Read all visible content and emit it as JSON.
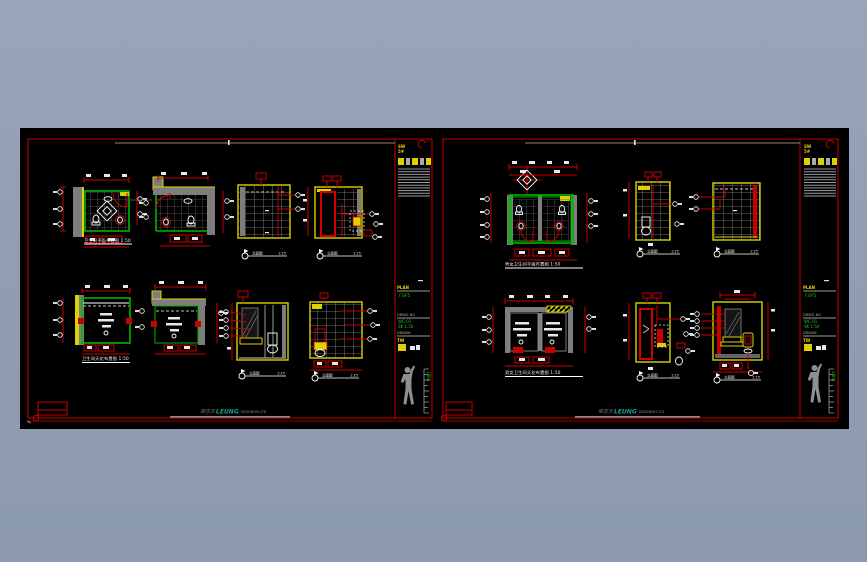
{
  "palette": {
    "background": "#909db2",
    "sheet": "#000000",
    "border_red": "#c80000",
    "accent_green": "#00b400",
    "accent_yellow": "#ddd200",
    "wall_gray": "#7d7d7d",
    "logo_teal": "#16a08f",
    "text_white": "#f2f2f2"
  },
  "labels": {
    "elev": "立面图",
    "scale": "1:25",
    "sw": "SW",
    "sw2": "5#",
    "ruler": "1800"
  },
  "titleblock": {
    "b1_label": "PLAN",
    "b1_value": "F3/F5",
    "b2_label": "DRWG NO",
    "b2_value1": "WC-01",
    "b2_value2": "SK 1:50",
    "b3_label": "DRAWN",
    "b3_value": "TW"
  },
  "logo": {
    "prefix": "梁志天",
    "name": "LEUNG",
    "suffix": "DESIGNERS LTD"
  },
  "left_sheet": {
    "plan_title": "卫生间平面布置图 1:50",
    "ceiling_title": "卫生间天花布置图 1:50"
  },
  "right_sheet": {
    "plan_title": "男女卫生间平面布置图 1:50",
    "ceiling_title": "男女卫生间天花布置图 1:50"
  }
}
